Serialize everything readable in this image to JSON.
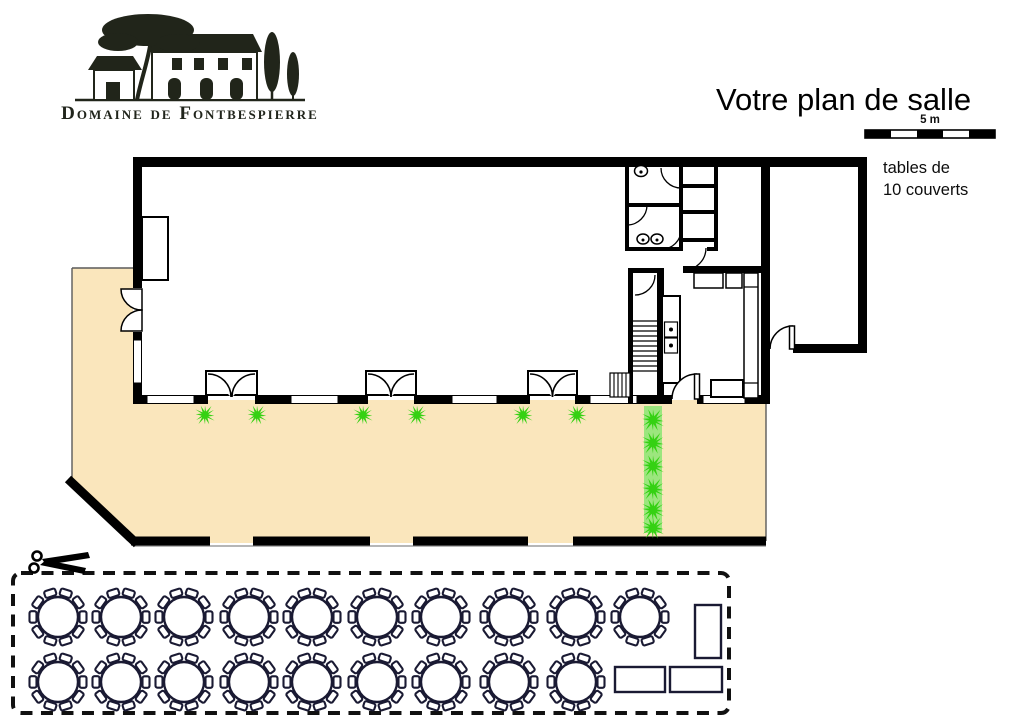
{
  "header": {
    "logo_text": "Domaine de Fontbespierre",
    "title": "Votre plan de salle",
    "scale": {
      "label": "5 m"
    },
    "legend": {
      "line1": "tables de",
      "line2": "10 couverts"
    }
  },
  "plan": {
    "colors": {
      "terrace": "#FAE6BC",
      "hedge": "#9CE67E",
      "plant": "#35D113",
      "wall": "#000000",
      "table_stroke": "#1A1A33"
    },
    "plants": {
      "terrace_row": {
        "y": 415,
        "xs": [
          205,
          257,
          363,
          417,
          523,
          577
        ]
      },
      "hedge_column": {
        "x": 653,
        "ys": [
          420,
          443,
          466,
          489,
          510,
          528
        ]
      }
    },
    "tables": {
      "seats_per_round_table": 10,
      "round_radius": 20,
      "round_rows": [
        {
          "y": 617,
          "xs": [
            58,
            121,
            184,
            249,
            312,
            377,
            441,
            509,
            576,
            640
          ]
        },
        {
          "y": 682,
          "xs": [
            58,
            121,
            184,
            249,
            312,
            377,
            441,
            509,
            576
          ]
        }
      ],
      "rect_tables": [
        {
          "x": 695,
          "y": 605,
          "w": 26,
          "h": 53
        },
        {
          "x": 615,
          "y": 667,
          "w": 50,
          "h": 25
        },
        {
          "x": 670,
          "y": 667,
          "w": 52,
          "h": 25
        }
      ]
    }
  }
}
